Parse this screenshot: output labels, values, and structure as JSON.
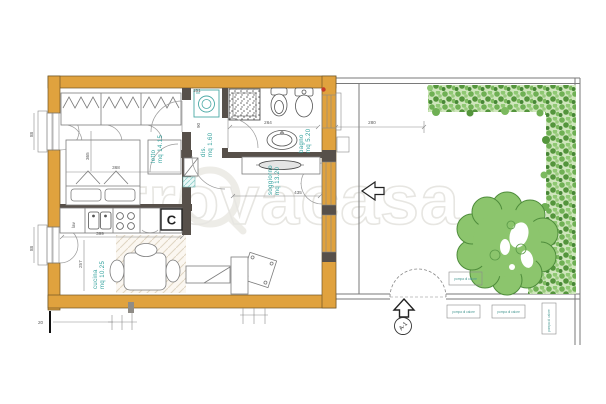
{
  "plan": {
    "watermark": "trovacasa",
    "rooms": [
      {
        "name": "letto",
        "area": "mq 14.15"
      },
      {
        "name": "dis.",
        "area": "mq 1.60"
      },
      {
        "name": "bagno",
        "area": "mq 5.20"
      },
      {
        "name": "soggiorno",
        "area": "mq 13.20"
      },
      {
        "name": "cucina",
        "area": "mq 10.25"
      }
    ],
    "dims": {
      "bed_w": "368",
      "bed_h": "365",
      "win_left_top": "88",
      "win_left_bottom": "88",
      "cucina_w": "399",
      "cucina_h": "257",
      "dis_w": "151",
      "dis_h": "90",
      "bagno_w": "264",
      "court_w": "280",
      "soggiorno_w": "435",
      "plinth": "20"
    },
    "labels": {
      "boiler": "C",
      "sink_cabinet": "lav",
      "heat_pump": "pompa di calore",
      "section_marker": "A-1"
    },
    "colors": {
      "wall": "#E0A23E",
      "wall_dark": "#57504A",
      "room_text": "#2FA09C",
      "hedge": "#79B75D",
      "tree": "#8CC56D"
    }
  }
}
